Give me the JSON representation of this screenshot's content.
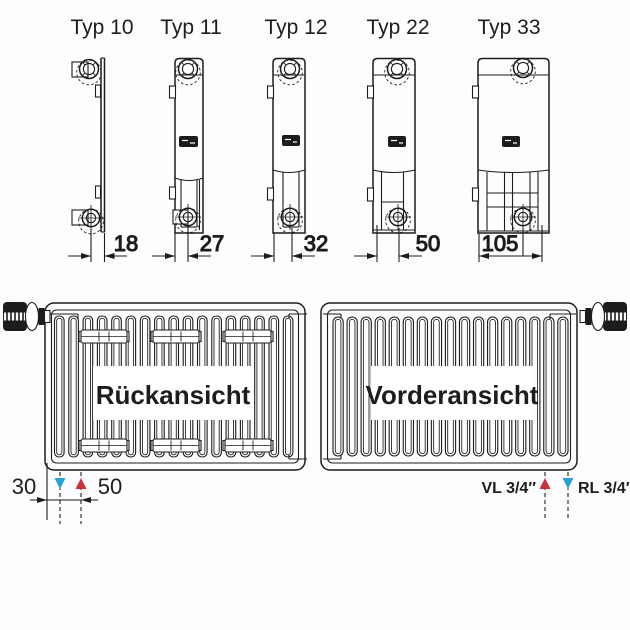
{
  "radiator_types": [
    {
      "label": "Typ 10",
      "depth_mm": "18"
    },
    {
      "label": "Typ 11",
      "depth_mm": "27"
    },
    {
      "label": "Typ 12",
      "depth_mm": "32"
    },
    {
      "label": "Typ 22",
      "depth_mm": "50"
    },
    {
      "label": "Typ 33",
      "depth_mm": "105"
    }
  ],
  "views": {
    "rear": {
      "label": "Rückansicht",
      "edge_offset_mm": "30",
      "pipe_spacing_mm": "50"
    },
    "front": {
      "label": "Vorderansicht",
      "flow_label": "VL 3/4″",
      "return_label": "RL 3/4″"
    }
  },
  "colors": {
    "line": "#1d1d1b",
    "flow_red": "#cd3038",
    "return_blue": "#2b9fd8",
    "background": "#fdfdfd"
  }
}
